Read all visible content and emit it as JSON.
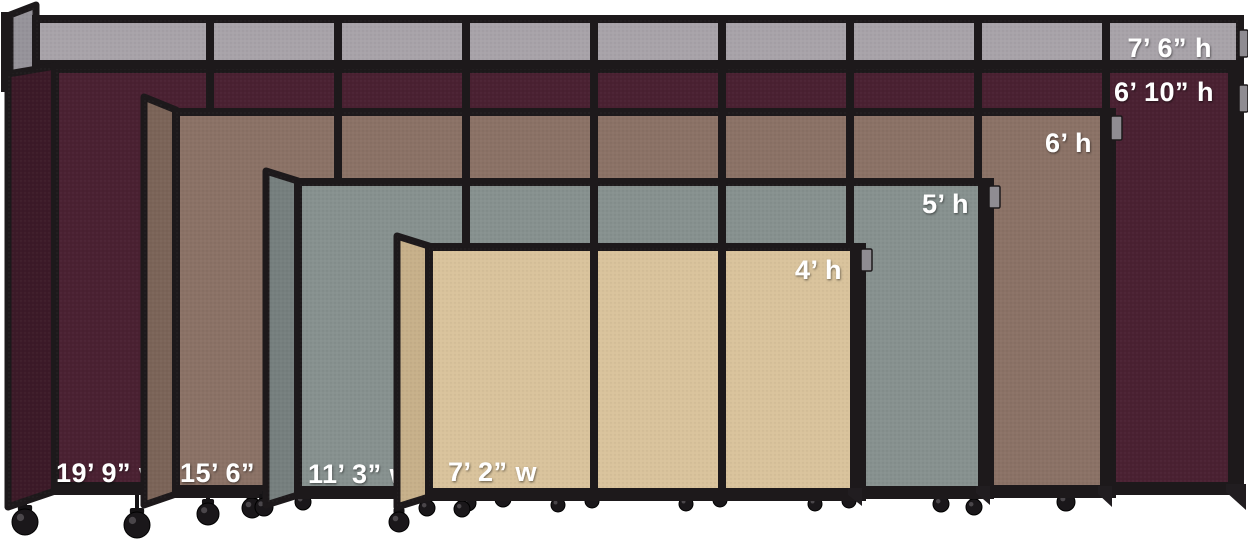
{
  "scene": {
    "description": "Portable room divider size comparison",
    "background": "#ffffff",
    "frame_color": "#1d191b",
    "label_color": "#ffffff",
    "bracket_color": "#8f8c92",
    "canvas": {
      "width": 1248,
      "height": 542
    }
  },
  "dividers": [
    {
      "id": "gray-7ft6",
      "fabric": "gray",
      "color": "#a8a3a9",
      "shade": "#96939a",
      "height_label": {
        "text": "7’ 6” h",
        "x": 1212,
        "y": 57,
        "anchor": "end"
      },
      "width_label": null,
      "geom": {
        "face": [
          36,
          19,
          1240,
          69
        ],
        "mullions": [
          210,
          338,
          466,
          594,
          722,
          850,
          978,
          1106
        ],
        "right_heavy": false,
        "angled": [
          [
            10,
            15
          ],
          [
            36,
            5
          ],
          [
            36,
            69
          ],
          [
            10,
            77
          ]
        ],
        "tab": [
          1239,
          30,
          9,
          27
        ],
        "wheels": [],
        "feet": []
      }
    },
    {
      "id": "cranberry-6ft10",
      "fabric": "cranberry",
      "color": "#4a2132",
      "shade": "#3c1a28",
      "height_label": {
        "text": "6’ 10” h",
        "x": 1214,
        "y": 101,
        "anchor": "end"
      },
      "width_label": {
        "text": "19’ 9” w",
        "x": 56,
        "y": 482,
        "anchor": "start"
      },
      "geom": {
        "face": [
          55,
          69,
          1240,
          491
        ],
        "mullions": [
          210,
          338,
          466,
          594,
          722,
          850,
          978,
          1106
        ],
        "right_heavy": true,
        "angled": [
          [
            8,
            74
          ],
          [
            55,
            66
          ],
          [
            55,
            491
          ],
          [
            8,
            507
          ]
        ],
        "tab": [
          1239,
          85,
          9,
          27
        ],
        "wheels": [
          [
            25,
            522,
            13
          ],
          [
            137,
            525,
            13
          ]
        ],
        "feet": [
          [
            [
              1226,
              484
            ],
            [
              1246,
              484
            ],
            [
              1246,
              510
            ],
            [
              1226,
              492
            ]
          ]
        ]
      }
    },
    {
      "id": "mocha-6ft",
      "fabric": "mocha",
      "color": "#8b7266",
      "shade": "#7b6458",
      "height_label": {
        "text": "6’ h",
        "x": 1092,
        "y": 152,
        "anchor": "end"
      },
      "width_label": {
        "text": "15’ 6” w",
        "x": 180,
        "y": 482,
        "anchor": "start"
      },
      "geom": {
        "face": [
          176,
          112,
          1112,
          494
        ],
        "mullions": [
          338,
          466,
          594,
          722,
          850,
          978
        ],
        "right_heavy": true,
        "angled": [
          [
            144,
            97
          ],
          [
            176,
            110
          ],
          [
            176,
            494
          ],
          [
            144,
            505
          ]
        ],
        "tab": [
          1111,
          116,
          11,
          24
        ],
        "wheels": [
          [
            208,
            514,
            11
          ],
          [
            252,
            508,
            10
          ],
          [
            1066,
            502,
            9
          ]
        ],
        "feet": [
          [
            [
              1098,
              486
            ],
            [
              1112,
              486
            ],
            [
              1112,
              507
            ],
            [
              1098,
              494
            ]
          ]
        ]
      }
    },
    {
      "id": "slate-5ft",
      "fabric": "slate",
      "color": "#87918f",
      "shade": "#767f7e",
      "height_label": {
        "text": "5’ h",
        "x": 969,
        "y": 213,
        "anchor": "end"
      },
      "width_label": {
        "text": "11’ 3” w",
        "x": 308,
        "y": 483,
        "anchor": "start"
      },
      "geom": {
        "face": [
          298,
          182,
          990,
          495
        ],
        "mullions": [
          466,
          594,
          722,
          850
        ],
        "right_heavy": true,
        "angled": [
          [
            266,
            171
          ],
          [
            298,
            181
          ],
          [
            298,
            495
          ],
          [
            266,
            505
          ]
        ],
        "tab": [
          989,
          186,
          11,
          22
        ],
        "wheels": [
          [
            264,
            507,
            9
          ],
          [
            303,
            502,
            8
          ],
          [
            399,
            522,
            10
          ],
          [
            468,
            503,
            8
          ],
          [
            503,
            499,
            8
          ],
          [
            941,
            504,
            8
          ],
          [
            974,
            507,
            8
          ]
        ],
        "feet": [
          [
            [
              976,
              486
            ],
            [
              990,
              486
            ],
            [
              990,
              505
            ],
            [
              976,
              493
            ]
          ]
        ]
      }
    },
    {
      "id": "sand-4ft",
      "fabric": "sand",
      "color": "#d9c39c",
      "shade": "#c7b08a",
      "height_label": {
        "text": "4’ h",
        "x": 842,
        "y": 279,
        "anchor": "end"
      },
      "width_label": {
        "text": "7’ 2” w",
        "x": 448,
        "y": 481,
        "anchor": "start"
      },
      "geom": {
        "face": [
          429,
          247,
          862,
          497
        ],
        "mullions": [
          594,
          722
        ],
        "right_heavy": true,
        "angled": [
          [
            397,
            236
          ],
          [
            429,
            246
          ],
          [
            429,
            497
          ],
          [
            397,
            507
          ]
        ],
        "tab": [
          861,
          249,
          11,
          22
        ],
        "wheels": [
          [
            427,
            508,
            8
          ],
          [
            462,
            509,
            8
          ],
          [
            558,
            505,
            7
          ],
          [
            592,
            501,
            7
          ],
          [
            686,
            504,
            7
          ],
          [
            720,
            500,
            7
          ],
          [
            815,
            504,
            7
          ],
          [
            849,
            501,
            7
          ]
        ],
        "feet": [
          [
            [
              848,
              488
            ],
            [
              862,
              488
            ],
            [
              862,
              506
            ],
            [
              848,
              495
            ]
          ]
        ]
      }
    }
  ],
  "wall_post": [
    1,
    12,
    9,
    80
  ]
}
